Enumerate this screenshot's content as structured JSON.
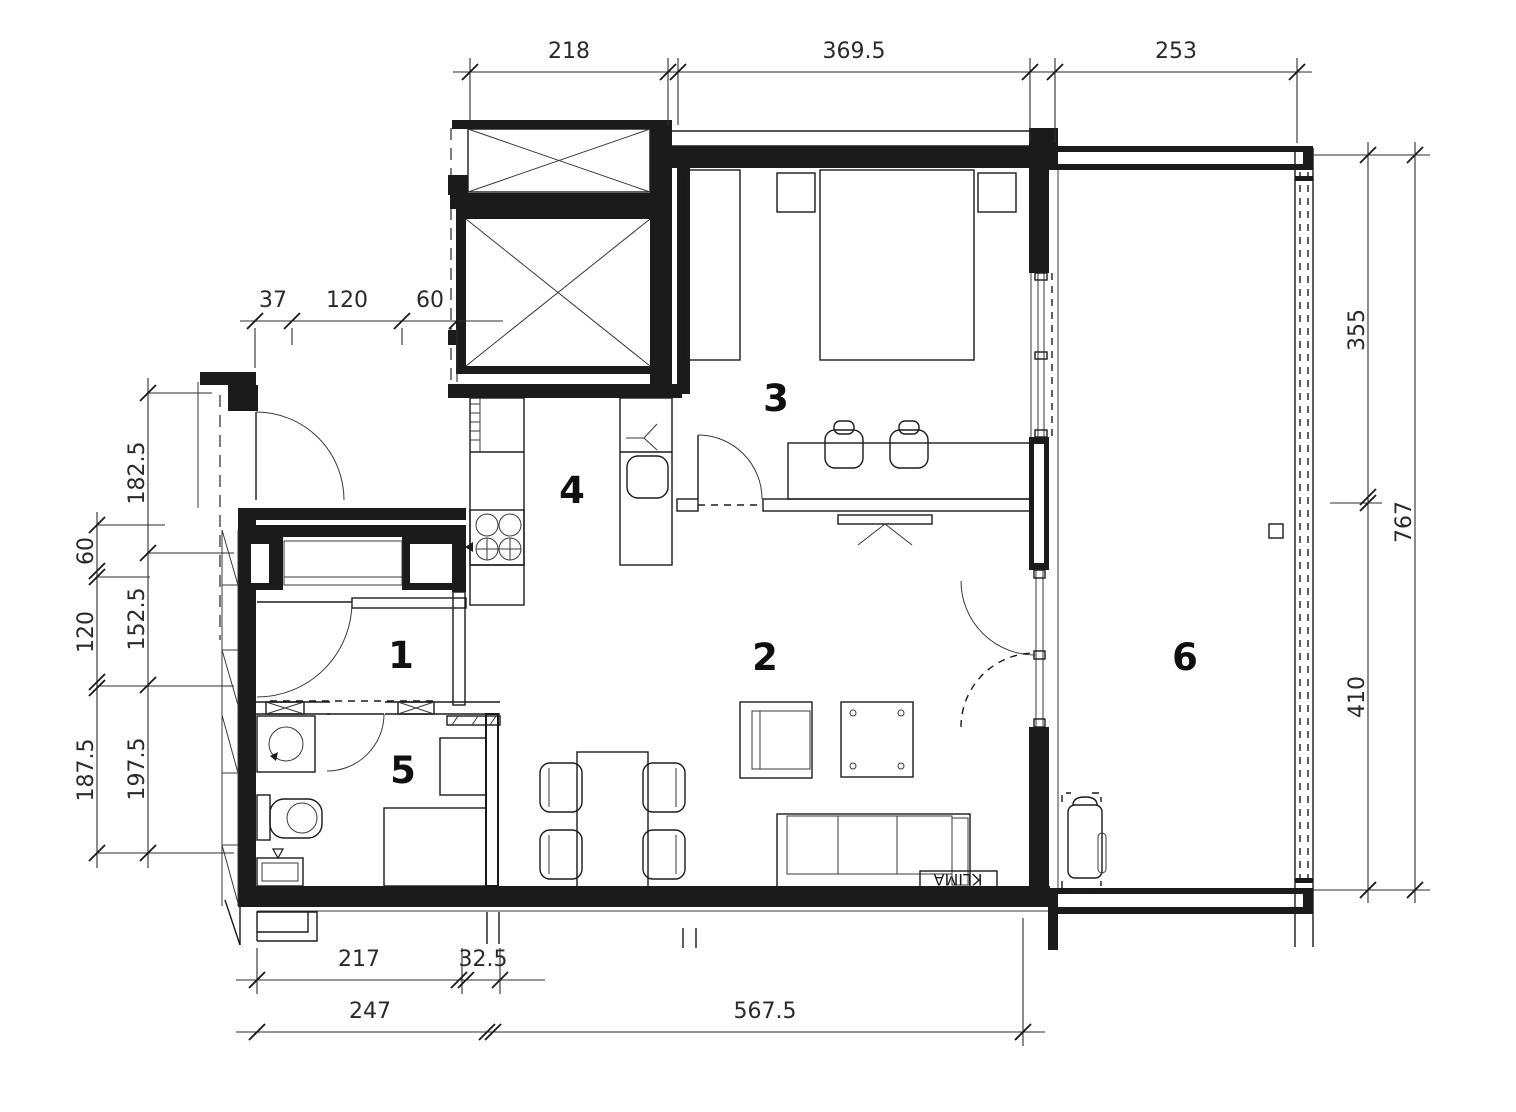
{
  "floor_plan": {
    "rooms": [
      {
        "label": "1"
      },
      {
        "label": "2"
      },
      {
        "label": "3"
      },
      {
        "label": "4"
      },
      {
        "label": "5"
      },
      {
        "label": "6"
      }
    ],
    "annotations": {
      "ac_unit": "KLIMA"
    },
    "dimensions_cm": {
      "top": [
        "218",
        "369.5",
        "253"
      ],
      "upper_left": [
        "37",
        "120",
        "60"
      ],
      "left_inner": [
        "182.5",
        "152.5",
        "197.5"
      ],
      "left_outer": [
        "60",
        "120",
        "187.5"
      ],
      "right_inner": [
        "355",
        "410"
      ],
      "right_outer": [
        "767"
      ],
      "bottom_upper": [
        "217",
        "32.5"
      ],
      "bottom_lower": [
        "247",
        "567.5"
      ]
    },
    "colors": {
      "ink": "#1b1b1b",
      "paper": "#ffffff"
    }
  }
}
